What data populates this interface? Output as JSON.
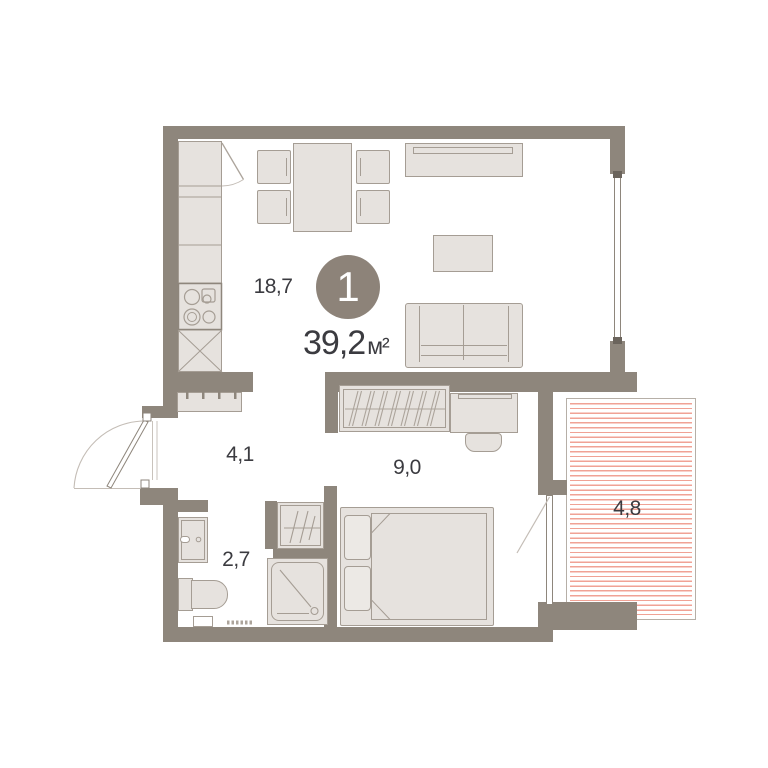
{
  "title": "Apartment floor plan",
  "colors": {
    "wall": "#8e867c",
    "fill": "#e6e2de",
    "border": "#a59d94",
    "line": "#aca49b",
    "hatch": "#f0a295",
    "balconyBorder": "#b6afa7",
    "text": "#3b3b40",
    "badge": "#8d8379",
    "badgeText": "#ffffff"
  },
  "unit": {
    "number": "1",
    "total_area": "39,2",
    "area_unit": "м²"
  },
  "rooms": [
    {
      "name": "kitchen-living-room",
      "area": "18,7"
    },
    {
      "name": "hallway",
      "area": "4,1"
    },
    {
      "name": "bedroom",
      "area": "9,0"
    },
    {
      "name": "bathroom",
      "area": "2,7"
    },
    {
      "name": "balcony",
      "area": "4,8"
    }
  ]
}
